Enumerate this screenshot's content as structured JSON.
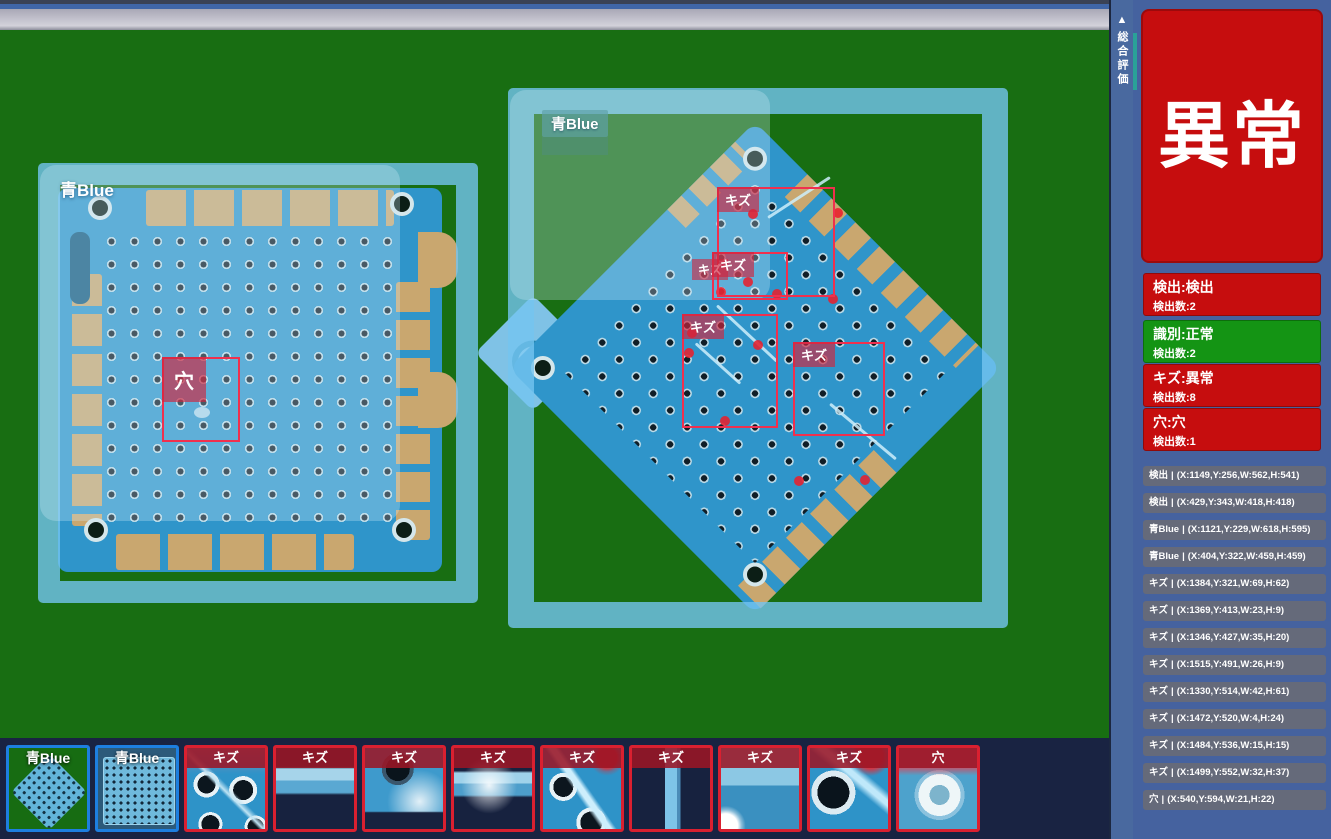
{
  "side_tab": {
    "collapse_icon": "▲",
    "label": "総合評価"
  },
  "overall_status": {
    "label": "異常"
  },
  "summary_panels": [
    {
      "title": "検出:検出",
      "count": "検出数:2",
      "state": "red"
    },
    {
      "title": "識別:正常",
      "count": "検出数:2",
      "state": "green"
    },
    {
      "title": "キズ:異常",
      "count": "検出数:8",
      "state": "red"
    },
    {
      "title": "穴:穴",
      "count": "検出数:1",
      "state": "red"
    }
  ],
  "detection_list": {
    "separator": "|",
    "items": [
      {
        "label": "検出",
        "coords": "(X:1149,Y:256,W:562,H:541)"
      },
      {
        "label": "検出",
        "coords": "(X:429,Y:343,W:418,H:418)"
      },
      {
        "label": "青Blue",
        "coords": "(X:1121,Y:229,W:618,H:595)"
      },
      {
        "label": "青Blue",
        "coords": "(X:404,Y:322,W:459,H:459)"
      },
      {
        "label": "キズ",
        "coords": "(X:1384,Y:321,W:69,H:62)"
      },
      {
        "label": "キズ",
        "coords": "(X:1369,Y:413,W:23,H:9)"
      },
      {
        "label": "キズ",
        "coords": "(X:1346,Y:427,W:35,H:20)"
      },
      {
        "label": "キズ",
        "coords": "(X:1515,Y:491,W:26,H:9)"
      },
      {
        "label": "キズ",
        "coords": "(X:1330,Y:514,W:42,H:61)"
      },
      {
        "label": "キズ",
        "coords": "(X:1472,Y:520,W:4,H:24)"
      },
      {
        "label": "キズ",
        "coords": "(X:1484,Y:536,W:15,H:15)"
      },
      {
        "label": "キズ",
        "coords": "(X:1499,Y:552,W:32,H:37)"
      },
      {
        "label": "穴",
        "coords": "(X:540,Y:594,W:21,H:22)"
      }
    ]
  },
  "viewer": {
    "left_overlay_label": "青Blue",
    "right_overlay_label": "青Blue",
    "box_labels": {
      "scratch": "キズ",
      "hole": "穴"
    }
  },
  "thumbnails": [
    {
      "label": "青Blue",
      "type": "blue"
    },
    {
      "label": "青Blue",
      "type": "blue"
    },
    {
      "label": "キズ",
      "type": "red"
    },
    {
      "label": "キズ",
      "type": "red"
    },
    {
      "label": "キズ",
      "type": "red"
    },
    {
      "label": "キズ",
      "type": "red"
    },
    {
      "label": "キズ",
      "type": "red"
    },
    {
      "label": "キズ",
      "type": "red"
    },
    {
      "label": "キズ",
      "type": "red"
    },
    {
      "label": "キズ",
      "type": "red"
    },
    {
      "label": "穴",
      "type": "red"
    }
  ],
  "colors": {
    "alert_red": "#c60d0e",
    "ok_green": "#149414",
    "box_red": "#f0304e",
    "overlay_blue": "#74c4f0",
    "thumb_blue_border": "#1d7fe0",
    "thumb_red_border": "#da2030",
    "sidebar_blue": "#45629f"
  }
}
